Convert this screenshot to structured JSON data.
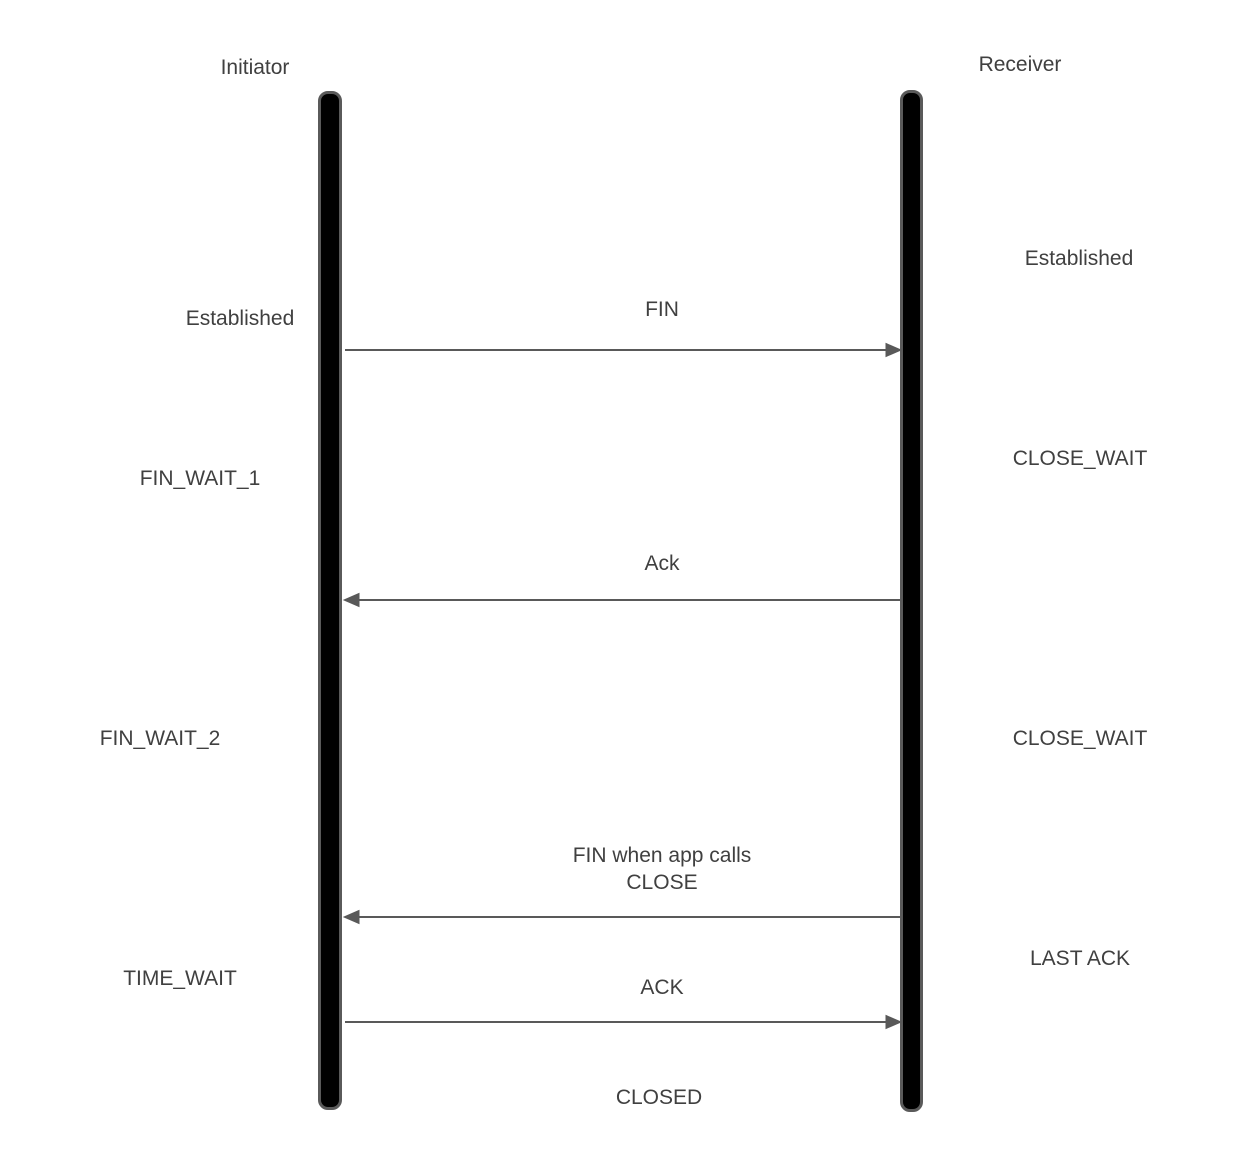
{
  "diagram_type": "tcp-teardown-sequence-diagram",
  "participants": [
    {
      "name": "Initiator"
    },
    {
      "name": "Receiver"
    }
  ],
  "initiator_states": [
    {
      "label": "Established"
    },
    {
      "label": "FIN_WAIT_1"
    },
    {
      "label": "FIN_WAIT_2"
    },
    {
      "label": "TIME_WAIT"
    }
  ],
  "receiver_states": [
    {
      "label": "Established"
    },
    {
      "label": "CLOSE_WAIT"
    },
    {
      "label": "CLOSE_WAIT"
    },
    {
      "label": "LAST ACK"
    }
  ],
  "messages": [
    {
      "label": "FIN",
      "from": "Initiator",
      "to": "Receiver",
      "direction": "right"
    },
    {
      "label": "Ack",
      "from": "Receiver",
      "to": "Initiator",
      "direction": "left"
    },
    {
      "label": "FIN when app calls\nCLOSE",
      "from": "Receiver",
      "to": "Initiator",
      "direction": "left"
    },
    {
      "label": "ACK",
      "from": "Initiator",
      "to": "Receiver",
      "direction": "right"
    }
  ],
  "final_state": {
    "label": "CLOSED"
  },
  "colors": {
    "background": "#ffffff",
    "text": "#404040",
    "arrow": "#595959",
    "lifeline_fill": "#000000",
    "lifeline_border": "#5a5a5a"
  }
}
